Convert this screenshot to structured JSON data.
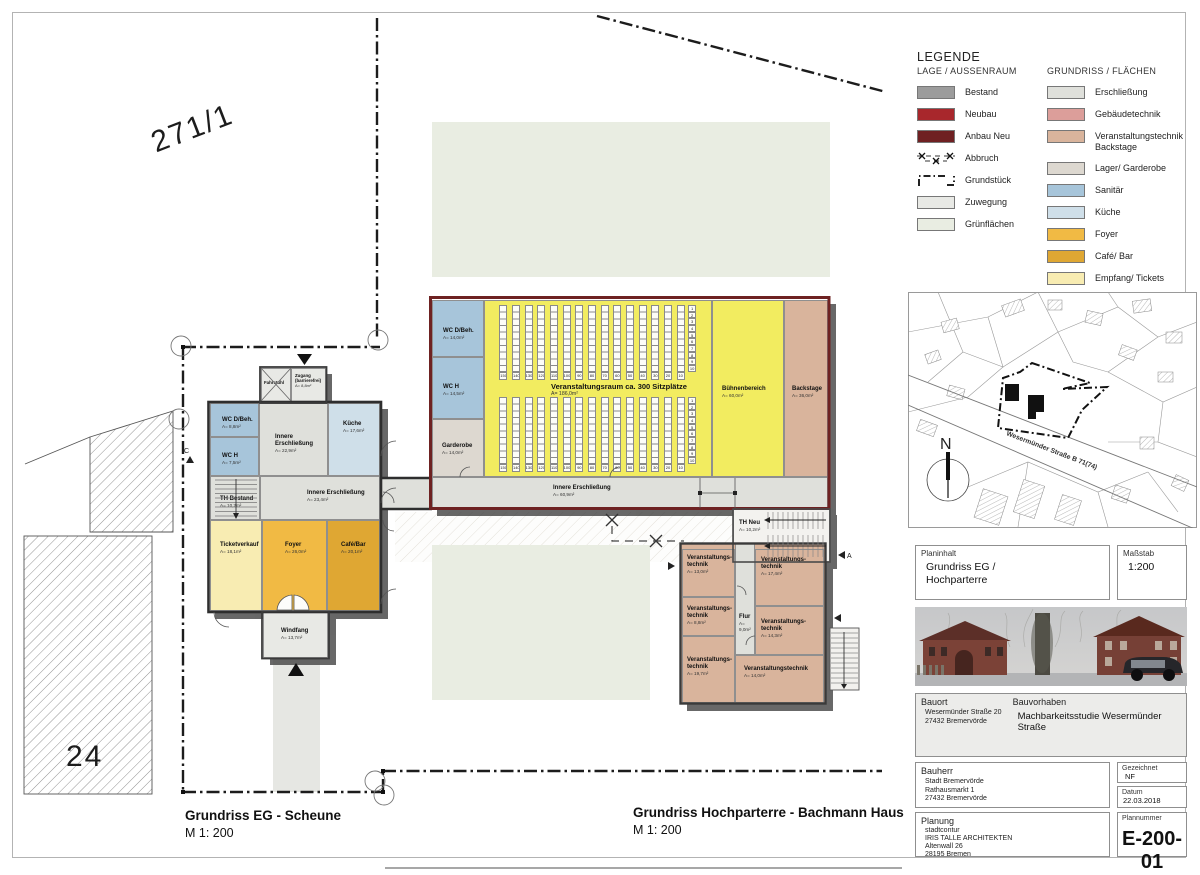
{
  "sheet": {
    "parcel_top": "271/1",
    "parcel_left": "24",
    "plan_titles": [
      {
        "title": "Grundriss EG - Scheune",
        "scale": "M 1: 200"
      },
      {
        "title": "Grundriss Hochparterre - Bachmann Haus",
        "scale": "M 1: 200"
      }
    ]
  },
  "colors": {
    "bestand": "#9c9c9c",
    "neubau": "#a8272c",
    "anbau_neu": "#6f2022",
    "zuwegung": "#e8e9e5",
    "gruen": "#e9ede2",
    "erschliessung": "#dfe0db",
    "gebaeudetechnik": "#dc9e9a",
    "backstage": "#d9b49c",
    "lager": "#ddd8d0",
    "sanitaer": "#a7c5da",
    "kueche": "#cfdfe9",
    "foyer": "#f1ba44",
    "cafe": "#dfa733",
    "tickets": "#f8ecb2",
    "veranstaltung": "#f2ec60",
    "wohnung": "#9dafd2",
    "buero": "#54b073",
    "wall_dark": "#2e2e2e",
    "wall_red": "#6e2222"
  },
  "legend": {
    "title": "LEGENDE",
    "columns": [
      {
        "header": "LAGE / AUSSENRAUM",
        "items": [
          {
            "label": "Bestand",
            "color": "bestand"
          },
          {
            "label": "Neubau",
            "color": "neubau"
          },
          {
            "label": "Anbau Neu",
            "color": "anbau_neu"
          },
          {
            "label": "Abbruch",
            "swatch": "abbruch"
          },
          {
            "label": "Grundstück",
            "swatch": "grundstueck"
          },
          {
            "label": "Zuwegung",
            "color": "zuwegung"
          },
          {
            "label": "Grünflächen",
            "color": "gruen"
          }
        ]
      },
      {
        "header": "GRUNDRISS / FLÄCHEN",
        "items": [
          {
            "label": "Erschließung",
            "color": "erschliessung"
          },
          {
            "label": "Gebäudetechnik",
            "color": "gebaeudetechnik"
          },
          {
            "label": "Veranstaltungstechnik Backstage",
            "color": "backstage"
          },
          {
            "label": "Lager/ Garderobe",
            "color": "lager"
          },
          {
            "label": "Sanitär",
            "color": "sanitaer"
          },
          {
            "label": "Küche",
            "color": "kueche"
          },
          {
            "label": "Foyer",
            "color": "foyer"
          },
          {
            "label": "Café/ Bar",
            "color": "cafe"
          },
          {
            "label": "Empfang/ Tickets",
            "color": "tickets"
          },
          {
            "label": "Veranstaltung",
            "color": "veranstaltung"
          },
          {
            "label": "Wohnung (Verwaltung)",
            "color": "wohnung"
          },
          {
            "label": "Büro (Verwaltung)",
            "color": "buero"
          }
        ]
      }
    ]
  },
  "rooms": {
    "fahrstuhl": {
      "name": "Fahrstuhl",
      "area": ""
    },
    "zugang": {
      "name": "Zugang (barrierefrei)",
      "area": "A= 8,8m²"
    },
    "s_wc_dbeh": {
      "name": "WC D/Beh.",
      "area": "A= 8,8m²"
    },
    "s_wc_h": {
      "name": "WC H",
      "area": "A= 7,5m²"
    },
    "s_inner1": {
      "name": "Innere Erschließung",
      "area": "A= 22,9m²"
    },
    "s_kueche": {
      "name": "Küche",
      "area": "A= 17,6m²"
    },
    "s_th": {
      "name": "TH Bestand",
      "area": "A= 10,2m²"
    },
    "s_inner2": {
      "name": "Innere Erschließung",
      "area": "A= 23,4m²"
    },
    "s_tickets": {
      "name": "Ticketverkauf",
      "area": "A= 18,1m²"
    },
    "s_foyer": {
      "name": "Foyer",
      "area": "A= 26,0m²"
    },
    "s_cafe": {
      "name": "Café/Bar",
      "area": "A= 20,1m²"
    },
    "s_windfang": {
      "name": "Windfang",
      "area": "A= 13,7m²"
    },
    "b_wc_dbeh": {
      "name": "WC D/Beh.",
      "area": "A= 14,0m²"
    },
    "b_wc_h": {
      "name": "WC H",
      "area": "A= 14,5m²"
    },
    "b_garderobe": {
      "name": "Garderobe",
      "area": "A= 14,0m²"
    },
    "b_buehne": {
      "name": "Bühnenbereich",
      "area": "A= 60,0m²"
    },
    "b_backstage": {
      "name": "Backstage",
      "area": "A= 36,0m²"
    },
    "b_corridor": {
      "name": "Innere Erschließung",
      "area": "A= 60,9m²"
    },
    "th_neu": {
      "name": "TH Neu",
      "area": "A= 10,2m²"
    },
    "a_vt1": {
      "name": "Veranstaltungs­technik",
      "area": "A= 13,0m²"
    },
    "a_vt2": {
      "name": "Veranstaltungs­technik",
      "area": "A= 8,8m²"
    },
    "a_vt3": {
      "name": "Veranstaltungs­technik",
      "area": "A= 19,7m²"
    },
    "a_flur": {
      "name": "Flur",
      "area": "A= 9,0m²"
    },
    "a_vt4": {
      "name": "Veranstaltungs­technik",
      "area": "A= 17,4m²"
    },
    "a_vt5": {
      "name": "Veranstaltungs­technik",
      "area": "A= 14,3m²"
    },
    "a_vt6": {
      "name": "Veranstaltungs­technik",
      "area": "A= 14,0m²"
    }
  },
  "hall": {
    "label": "Veranstaltungsraum ca. 300 Sitzplätze",
    "area": "A= 186,0m²",
    "col_labels": [
      "150",
      "140",
      "130",
      "120",
      "110",
      "100",
      "90",
      "80",
      "70",
      "60",
      "50",
      "40",
      "30",
      "20",
      "10"
    ],
    "row_numbers": [
      "1",
      "2",
      "3",
      "4",
      "5",
      "6",
      "7",
      "8",
      "9",
      "10"
    ]
  },
  "site_map": {
    "street": "Wesermünder Straße B 71(74)",
    "north": "N"
  },
  "title_block": {
    "planinhalt_label": "Planinhalt",
    "planinhalt_lines": [
      "Grundriss EG /",
      "Hochparterre"
    ],
    "massstab_label": "Maßstab",
    "massstab": "1:200",
    "bauort_label": "Bauort",
    "bauort_lines": [
      "Wesermünder Straße 20",
      "27432 Bremervörde"
    ],
    "bauvorhaben_label": "Bauvorhaben",
    "bauvorhaben": "Machbarkeitsstudie Wesermünder Straße",
    "bauherr_label": "Bauherr",
    "bauherr_lines": [
      "Stadt Bremervörde",
      "Rathausmarkt 1",
      "27432 Bremervörde"
    ],
    "gezeichnet_label": "Gezeichnet",
    "gezeichnet": "NF",
    "datum_label": "Datum",
    "datum": "22.03.2018",
    "planung_label": "Planung",
    "planung_lines": [
      "stadtcontur",
      "IRIS TALLE ARCHITEKTEN",
      "Altenwall 26",
      "28195 Bremen"
    ],
    "plannummer_label": "Plannummer",
    "plannummer": "E-200-01"
  }
}
